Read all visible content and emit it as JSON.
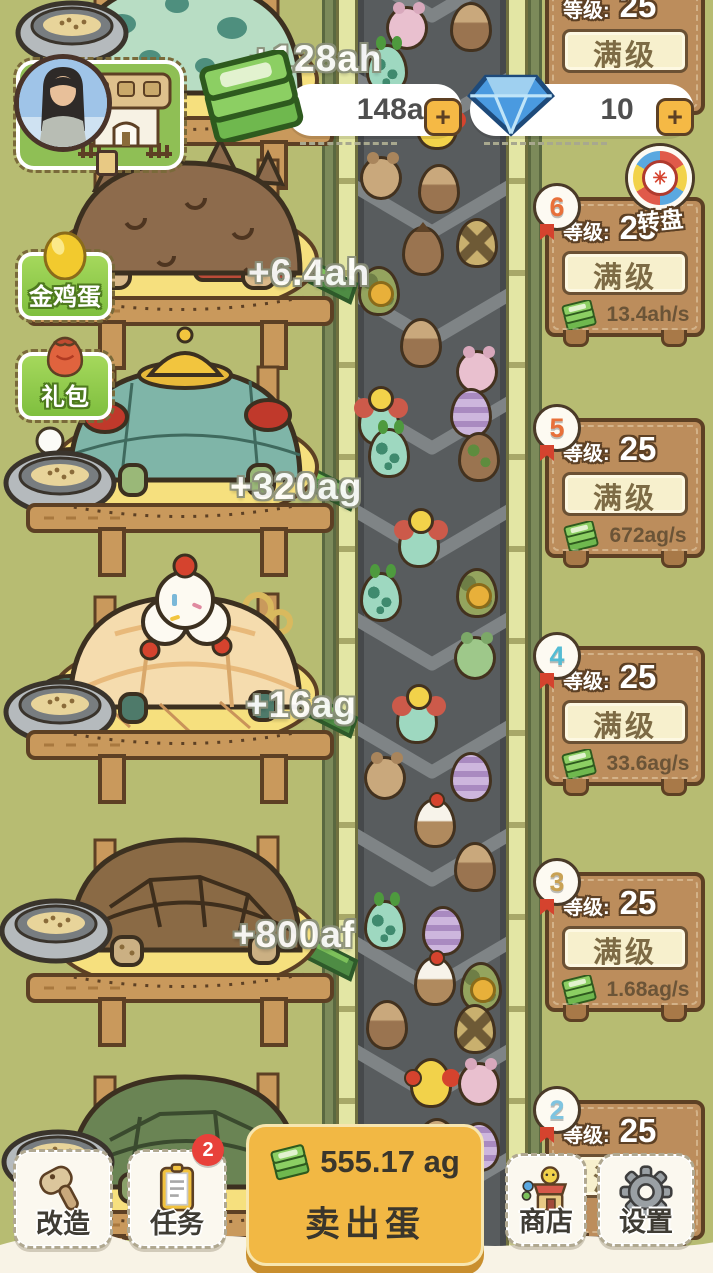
{
  "app": {
    "background_color": "#b7bc72"
  },
  "top_bar": {
    "money": {
      "value": "148ar",
      "plus": "+"
    },
    "gems": {
      "value": "10",
      "plus": "+"
    }
  },
  "left_buttons": {
    "golden_egg": "金鸡蛋",
    "gift_pack": "礼包"
  },
  "wheel": {
    "label": "转盘",
    "hub_glyph": "✳"
  },
  "panel_labels": {
    "level": "等级:",
    "max": "满级"
  },
  "panels": [
    {
      "top": -25,
      "badge": null,
      "badge_color": null,
      "level": "25",
      "rate": null
    },
    {
      "top": 197,
      "badge": "6",
      "badge_color": "#e8703a",
      "level": "25",
      "rate": "13.4ah/s"
    },
    {
      "top": 418,
      "badge": "5",
      "badge_color": "#e8703a",
      "level": "25",
      "rate": "672ag/s"
    },
    {
      "top": 646,
      "badge": "4",
      "badge_color": "#54bcd4",
      "level": "25",
      "rate": "33.6ag/s"
    },
    {
      "top": 872,
      "badge": "3",
      "badge_color": "#c9a254",
      "level": "25",
      "rate": "1.68ag/s"
    },
    {
      "top": 1100,
      "badge": "2",
      "badge_color": "#7fc4e0",
      "level": "25",
      "rate": null
    }
  ],
  "floating_gains": [
    {
      "text": "+128ah",
      "x": 250,
      "y": 38
    },
    {
      "text": "+6.4ah",
      "x": 248,
      "y": 252
    },
    {
      "text": "+320ag",
      "x": 230,
      "y": 466
    },
    {
      "text": "+16ag",
      "x": 246,
      "y": 684
    },
    {
      "text": "+800af",
      "x": 233,
      "y": 914
    }
  ],
  "bottom_bar": {
    "renovate": "改造",
    "tasks": "任务",
    "tasks_badge": "2",
    "sell_amount": "555.17 ag",
    "sell_label": "卖出蛋",
    "shop": "商店",
    "settings": "设置"
  },
  "belt": {
    "eggs": [
      {
        "x": 28,
        "y": 6,
        "type": "mouse-pink"
      },
      {
        "x": 92,
        "y": 2,
        "type": "brown-hatch"
      },
      {
        "x": 8,
        "y": 44,
        "type": "teal-spot"
      },
      {
        "x": 58,
        "y": 100,
        "type": "gold-bow"
      },
      {
        "x": 2,
        "y": 156,
        "type": "mouse-brown"
      },
      {
        "x": 60,
        "y": 164,
        "type": "brown-hatch"
      },
      {
        "x": 98,
        "y": 218,
        "type": "yellow-x"
      },
      {
        "x": 44,
        "y": 226,
        "type": "brown-spike"
      },
      {
        "x": 0,
        "y": 266,
        "type": "camo-coin"
      },
      {
        "x": 42,
        "y": 318,
        "type": "brown-hatch"
      },
      {
        "x": 98,
        "y": 350,
        "type": "mouse-pink"
      },
      {
        "x": 92,
        "y": 388,
        "type": "purple-stripe"
      },
      {
        "x": 0,
        "y": 396,
        "type": "chick"
      },
      {
        "x": 10,
        "y": 428,
        "type": "teal-spot"
      },
      {
        "x": 100,
        "y": 432,
        "type": "brown-leaf"
      },
      {
        "x": 40,
        "y": 518,
        "type": "chick"
      },
      {
        "x": 2,
        "y": 572,
        "type": "teal-spot"
      },
      {
        "x": 98,
        "y": 568,
        "type": "camo-coin"
      },
      {
        "x": 96,
        "y": 636,
        "type": "mouse-green"
      },
      {
        "x": 38,
        "y": 694,
        "type": "chick"
      },
      {
        "x": 6,
        "y": 756,
        "type": "mouse-brown"
      },
      {
        "x": 92,
        "y": 752,
        "type": "purple-stripe"
      },
      {
        "x": 56,
        "y": 798,
        "type": "cake"
      },
      {
        "x": 96,
        "y": 842,
        "type": "brown-hatch"
      },
      {
        "x": 6,
        "y": 900,
        "type": "teal-spot"
      },
      {
        "x": 64,
        "y": 906,
        "type": "purple-stripe"
      },
      {
        "x": 56,
        "y": 956,
        "type": "cake"
      },
      {
        "x": 102,
        "y": 962,
        "type": "camo-coin"
      },
      {
        "x": 8,
        "y": 1000,
        "type": "brown-hatch"
      },
      {
        "x": 96,
        "y": 1004,
        "type": "yellow-x"
      },
      {
        "x": 52,
        "y": 1058,
        "type": "gold-bow"
      },
      {
        "x": 100,
        "y": 1062,
        "type": "mouse-pink"
      },
      {
        "x": 58,
        "y": 1118,
        "type": "brown-hatch"
      },
      {
        "x": 100,
        "y": 1122,
        "type": "purple-stripe"
      },
      {
        "x": 38,
        "y": 1178,
        "type": "cake"
      },
      {
        "x": 58,
        "y": 1232,
        "type": "purple-stripe"
      },
      {
        "x": 6,
        "y": 1238,
        "type": "brown-hatch"
      }
    ]
  }
}
